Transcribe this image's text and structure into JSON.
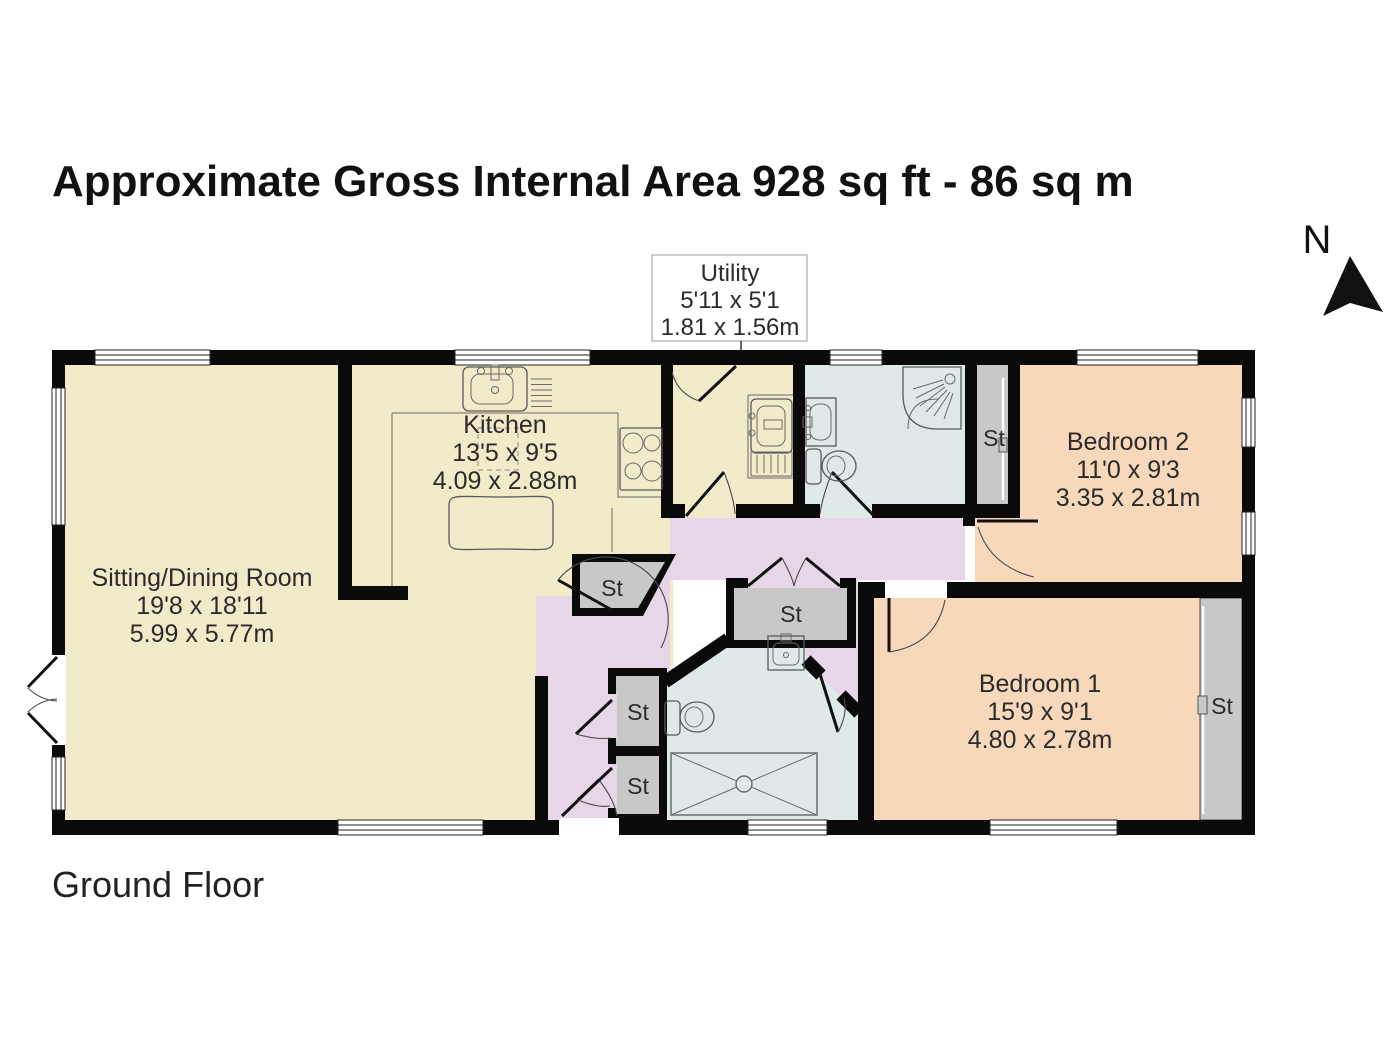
{
  "title": "Approximate Gross Internal Area 928 sq ft - 86 sq m",
  "floor_label": "Ground Floor",
  "compass": {
    "north_label": "N"
  },
  "utility_callout": {
    "name": "Utility",
    "dims_imperial": "5'11 x 5'1",
    "dims_metric": "1.81 x 1.56m"
  },
  "rooms": {
    "sitting_dining": {
      "name": "Sitting/Dining Room",
      "dims_imperial": "19'8 x 18'11",
      "dims_metric": "5.99 x 5.77m"
    },
    "kitchen": {
      "name": "Kitchen",
      "dims_imperial": "13'5 x 9'5",
      "dims_metric": "4.09 x 2.88m"
    },
    "bedroom2": {
      "name": "Bedroom 2",
      "dims_imperial": "11'0 x 9'3",
      "dims_metric": "3.35 x 2.81m"
    },
    "bedroom1": {
      "name": "Bedroom 1",
      "dims_imperial": "15'9 x 9'1",
      "dims_metric": "4.80 x 2.78m"
    }
  },
  "storage": {
    "label": "St"
  },
  "colors": {
    "living_kitchen": "#f1ebc9",
    "hallway": "#e7d5e8",
    "bathroom": "#dfe9e9",
    "bedroom": "#f7d8bb",
    "storage": "#c8c8c8",
    "wall": "#0a0a0a"
  }
}
